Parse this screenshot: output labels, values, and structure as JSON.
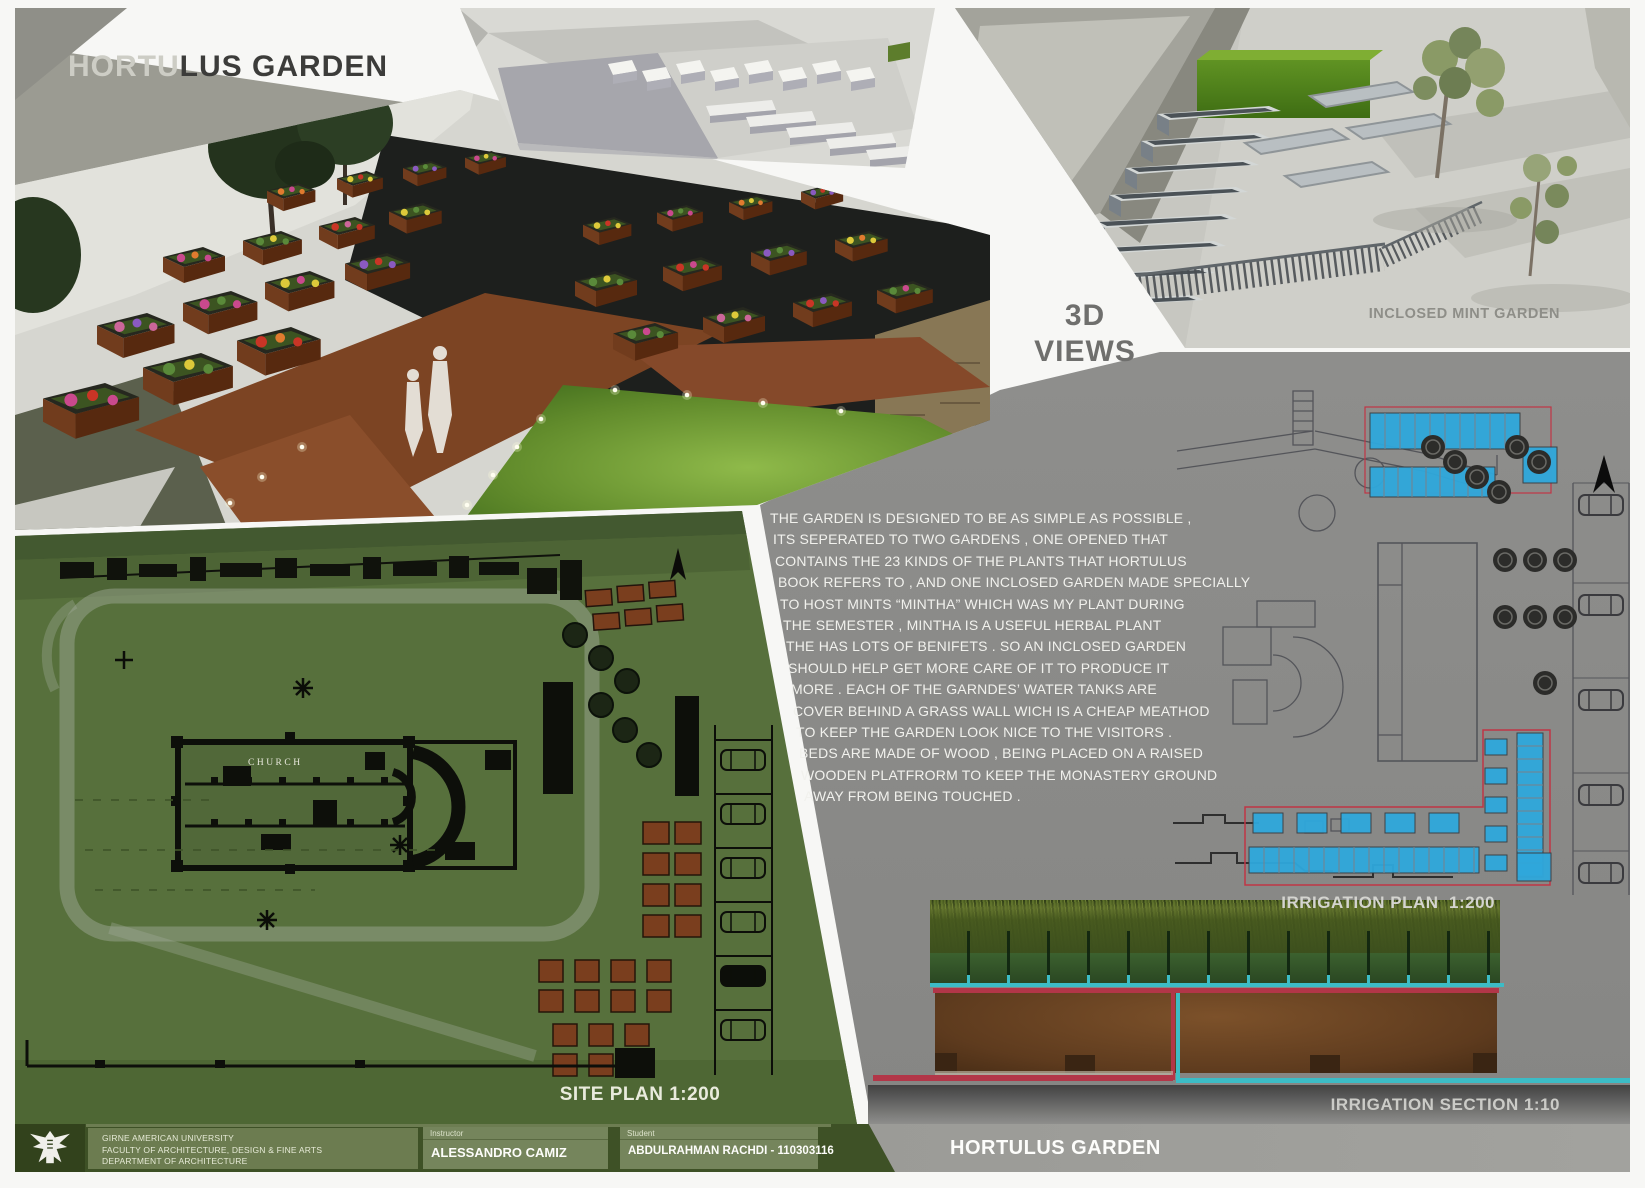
{
  "board": {
    "title_full": "HORTULUS GARDEN",
    "title_part_on_gray": "HORTU",
    "title_part_on_white": "LUS GARDEN"
  },
  "labels": {
    "views_3d_top": "3D",
    "views_3d_bottom": "VIEWS",
    "inclosed_mint_garden": "INCLOSED MINT GARDEN",
    "site_plan": "SITE PLAN 1:200",
    "irrigation_plan": "IRRIGATION PLAN  1:200",
    "irrigation_section": "IRRIGATION SECTION 1:10",
    "church": "CHURCH"
  },
  "description": {
    "lines": [
      "THE GARDEN IS DESIGNED TO BE AS SIMPLE AS POSSIBLE ,",
      "ITS SEPERATED TO TWO GARDENS , ONE OPENED THAT",
      "CONTAINS THE 23 KINDS OF THE PLANTS THAT HORTULUS",
      "BOOK REFERS TO , AND ONE INCLOSED GARDEN MADE SPECIALLY",
      "TO HOST MINTS “MINTHA” WHICH WAS MY PLANT DURING",
      "THE SEMESTER , MINTHA IS A USEFUL HERBAL PLANT",
      "THE HAS LOTS OF BENIFETS . SO AN INCLOSED GARDEN",
      "SHOULD HELP GET MORE CARE OF IT TO PRODUCE IT",
      "MORE . EACH OF THE GARNDES’ WATER TANKS ARE",
      "COVER BEHIND A GRASS WALL WICH IS A CHEAP MEATHOD",
      "TO KEEP THE GARDEN LOOK NICE TO THE VISITORS .",
      "BEDS ARE MADE OF WOOD , BEING PLACED ON A RAISED",
      "WOODEN PLATFRORM TO KEEP THE MONASTERY GROUND",
      "AWAY FROM BEING TOUCHED ."
    ]
  },
  "footer": {
    "university_line1": "GIRNE AMERICAN UNIVERSITY",
    "university_line2": "FACULTY OF ARCHITECTURE, DESIGN & FINE ARTS",
    "university_line3": "DEPARTMENT OF ARCHITECTURE",
    "instructor_label": "Instructor",
    "instructor_name": "ALESSANDRO CAMIZ",
    "student_label": "Student",
    "student_name": "ABDULRAHMAN RACHDI - 110303116",
    "project_title": "HORTULUS GARDEN"
  },
  "colors": {
    "bed_highlight_blue": "#2fa8dc",
    "pipe_red": "#b23648",
    "pipe_cyan": "#3cbcc6",
    "site_plan_green": "#57703c",
    "footer_green": "#3e5126",
    "panel_gray": "#8e8e8c"
  }
}
